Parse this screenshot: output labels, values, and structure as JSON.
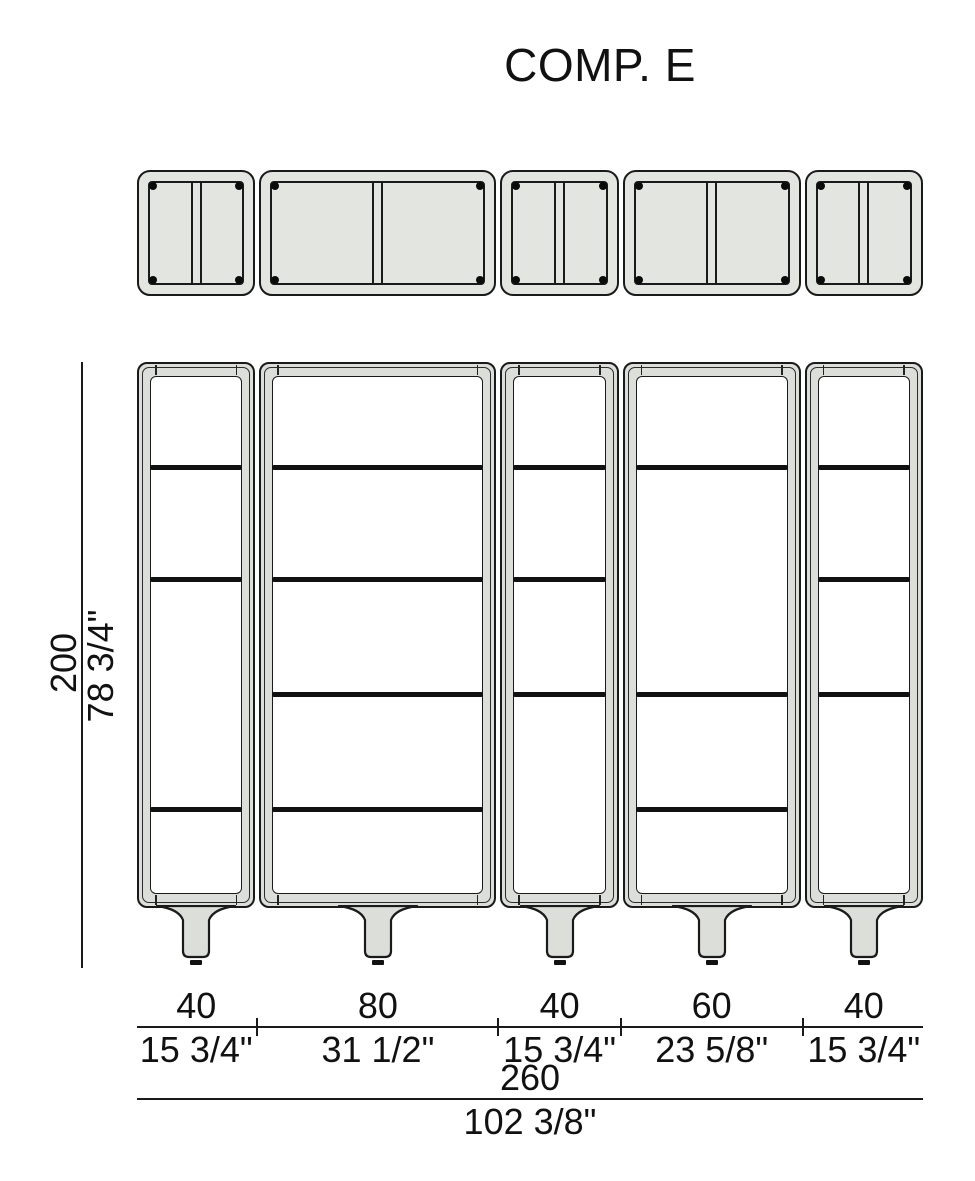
{
  "title": "COMP. E",
  "colors": {
    "line": "#1a1a1a",
    "plan_fill": "#e3e6e0",
    "frame_fill": "#dbded9",
    "interior": "#ffffff"
  },
  "height_dim": {
    "cm": "200",
    "inches": "78 3/4\""
  },
  "width_dims": {
    "segments": [
      {
        "cm": "40",
        "inches": "15 3/4\""
      },
      {
        "cm": "80",
        "inches": "31 1/2\""
      },
      {
        "cm": "40",
        "inches": "15 3/4\""
      },
      {
        "cm": "60",
        "inches": "23 5/8\""
      },
      {
        "cm": "40",
        "inches": "15 3/4\""
      }
    ],
    "total": {
      "cm": "260",
      "inches": "102 3/8\""
    }
  },
  "composition": {
    "total_width_cm": 260,
    "height_cm": 200,
    "units": [
      {
        "width_cm": 40,
        "shelf_fractions": [
          0.189,
          0.394,
          0.815
        ]
      },
      {
        "width_cm": 80,
        "shelf_fractions": [
          0.189,
          0.394,
          0.604,
          0.815
        ]
      },
      {
        "width_cm": 40,
        "shelf_fractions": [
          0.189,
          0.394,
          0.604
        ]
      },
      {
        "width_cm": 60,
        "shelf_fractions": [
          0.189,
          0.604,
          0.815
        ]
      },
      {
        "width_cm": 40,
        "shelf_fractions": [
          0.189,
          0.394,
          0.604
        ]
      }
    ]
  }
}
